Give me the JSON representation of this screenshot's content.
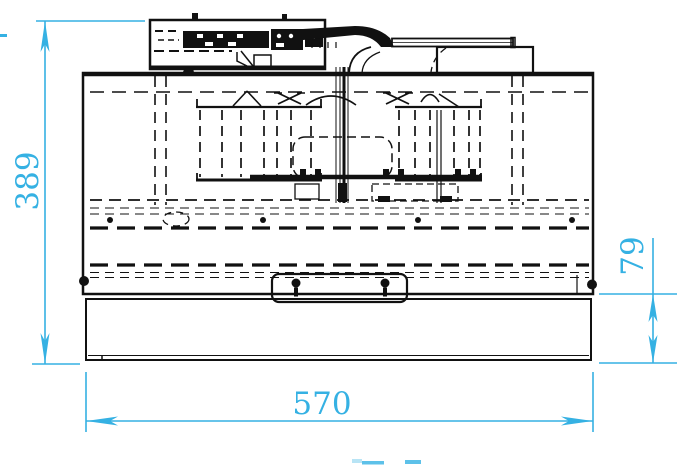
{
  "drawing": {
    "title": "range-hood-front-view-technical-drawing",
    "view": "front",
    "units": "mm",
    "line_color": "#111111",
    "dimension_color": "#35b1e3",
    "background": "#ffffff",
    "dimensions": [
      {
        "id": "overall-height",
        "label": "389",
        "value": 389,
        "orientation": "vertical",
        "location": "left"
      },
      {
        "id": "overall-width",
        "label": "570",
        "value": 570,
        "orientation": "horizontal",
        "location": "bottom"
      },
      {
        "id": "front-panel-height",
        "label": "79",
        "value": 79,
        "orientation": "vertical",
        "location": "right"
      }
    ],
    "components": [
      "control-box",
      "duct-elbow",
      "exhaust-duct",
      "rear-plenum",
      "hood-body",
      "blower-left",
      "blower-right",
      "motor",
      "handle",
      "front-panel"
    ]
  }
}
